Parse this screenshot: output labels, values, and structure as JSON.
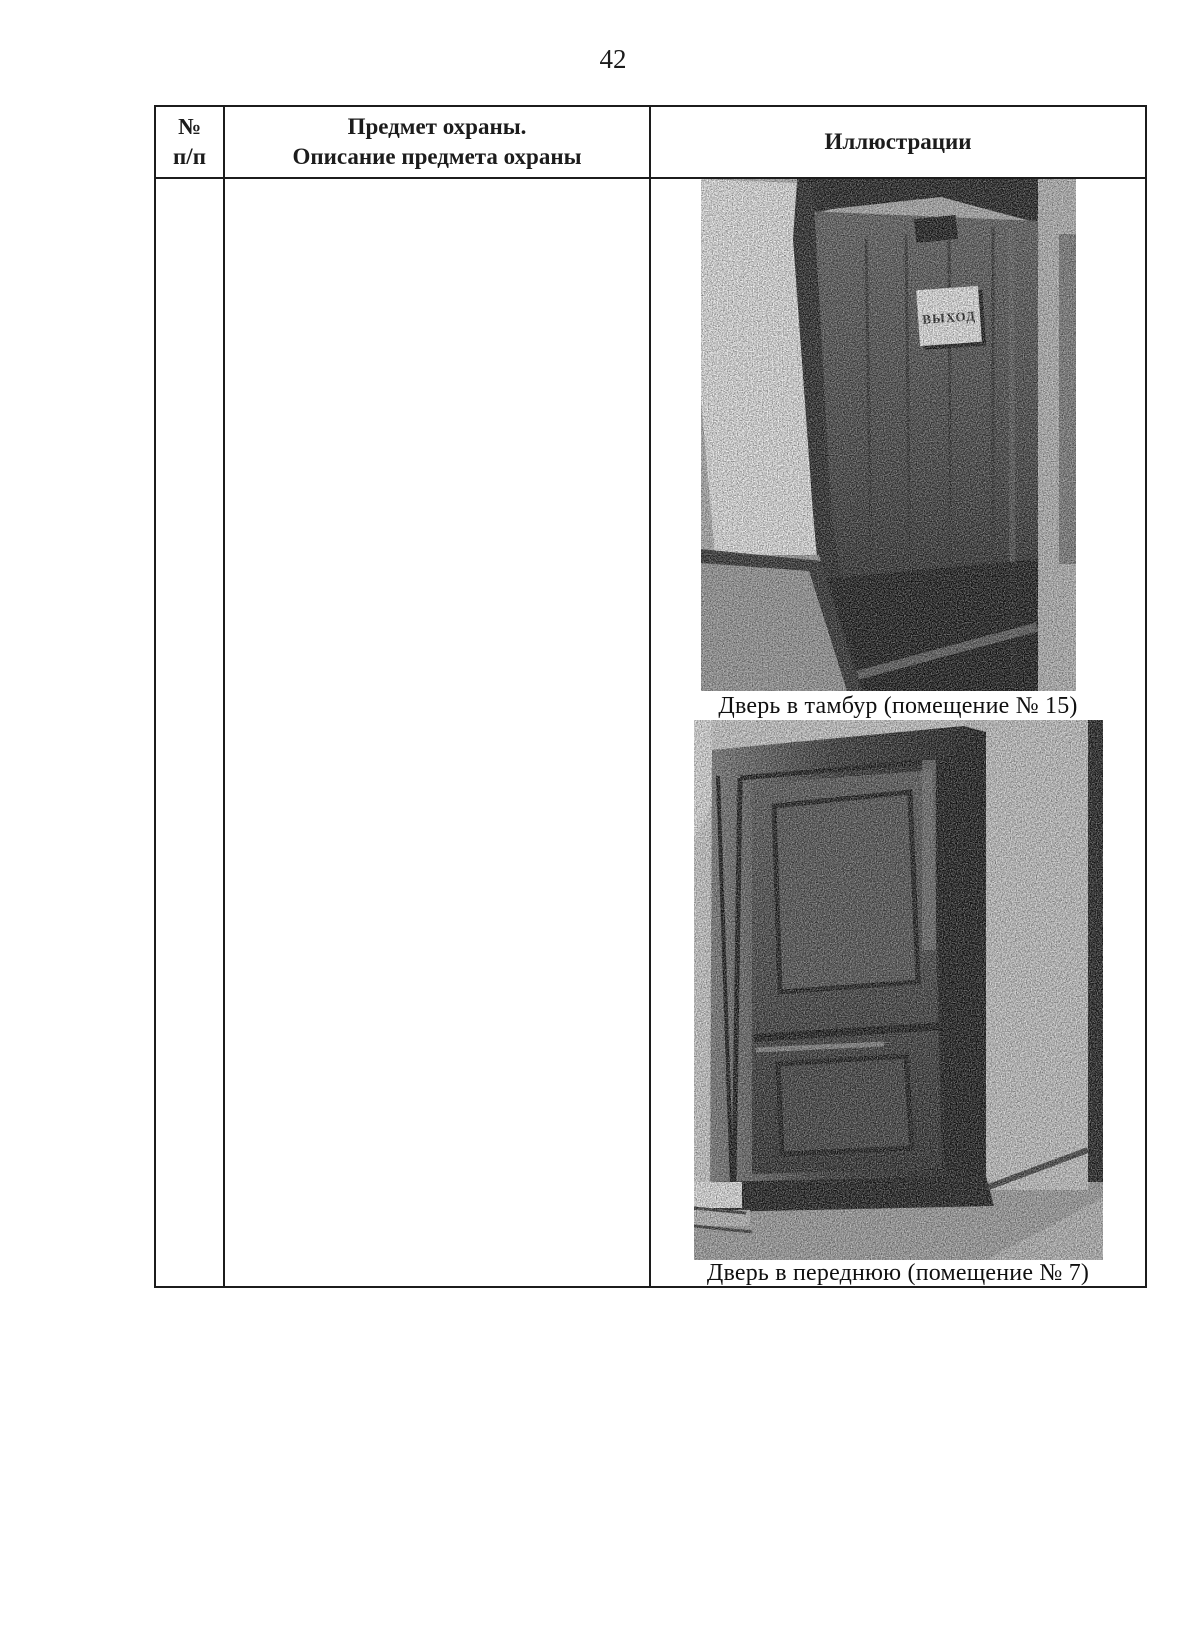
{
  "page": {
    "number": "42"
  },
  "table": {
    "header": {
      "col_number": "№\nп/п",
      "col_subject": "Предмет охраны.\nОписание предмета охраны",
      "col_illustrations": "Иллюстрации"
    },
    "row": {
      "number": "",
      "description": "",
      "illustrations": [
        {
          "caption": "Дверь в тамбур (помещение № 15)",
          "sign_label": "ВЫХОД"
        },
        {
          "caption": "Дверь в переднюю (помещение № 7)"
        }
      ]
    }
  },
  "colors": {
    "ink": "#1c1c1c",
    "paper": "#ffffff"
  }
}
